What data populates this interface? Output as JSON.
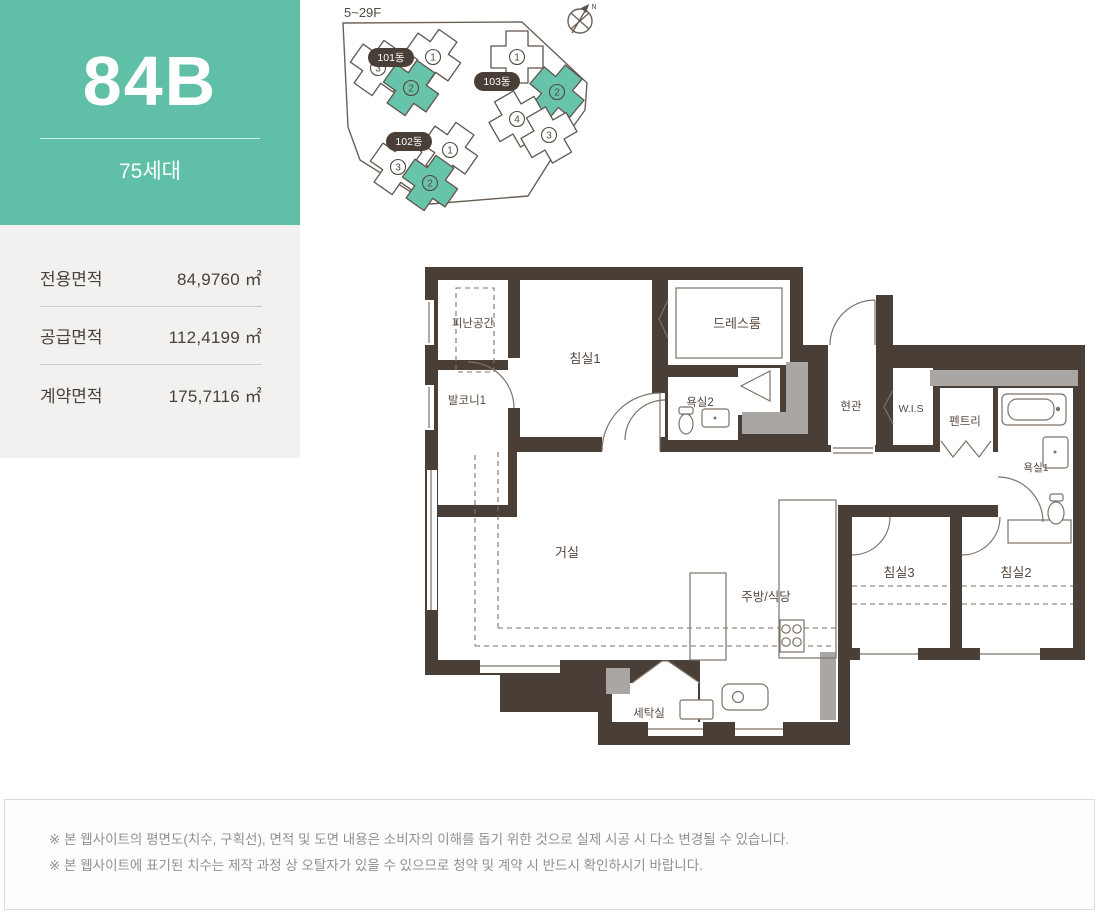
{
  "colors": {
    "accent_teal": "#5fc0a7",
    "building_teal": "#68c3ab",
    "wall": "#493f37",
    "gray_accent": "#a9a6a3",
    "line": "#7d7268",
    "ink": "#57493e",
    "badge": "#4a3f37",
    "panel_bg": "#f2f1ef"
  },
  "unit": {
    "code": "84B",
    "households": "75세대"
  },
  "area_table": {
    "rows": [
      {
        "label": "전용면적",
        "value": "84,9760 ㎡"
      },
      {
        "label": "공급면적",
        "value": "112,4199 ㎡"
      },
      {
        "label": "계약면적",
        "value": "175,7116 ㎡"
      }
    ]
  },
  "site_plan": {
    "floors_label": "5~29F",
    "compass_label": "N",
    "buildings": [
      {
        "name": "101동",
        "units": [
          {
            "no": "3"
          },
          {
            "no": "1"
          },
          {
            "no": "2",
            "highlight": true
          }
        ]
      },
      {
        "name": "102동",
        "units": [
          {
            "no": "3"
          },
          {
            "no": "1"
          },
          {
            "no": "2",
            "highlight": true
          }
        ]
      },
      {
        "name": "103동",
        "units": [
          {
            "no": "1"
          },
          {
            "no": "2",
            "highlight": true
          },
          {
            "no": "4"
          },
          {
            "no": "3"
          }
        ]
      }
    ]
  },
  "floor_plan": {
    "labels": {
      "refuge": "피난공간",
      "balcony1": "발코니1",
      "bedroom1": "침실1",
      "dressroom": "드레스룸",
      "bath2": "욕실2",
      "entry": "현관",
      "wis": "W.I.S",
      "pantry": "펜트리",
      "bath1": "욕실1",
      "living": "거실",
      "kitchen": "주방/식당",
      "bedroom3": "침실3",
      "bedroom2": "침실2",
      "laundry": "세탁실"
    }
  },
  "disclaimer": {
    "lines": [
      "※ 본 웹사이트의 평면도(치수, 구획선), 면적 및 도면 내용은 소비자의 이해를 돕기 위한 것으로 실제 시공 시 다소 변경될 수 있습니다.",
      "※ 본 웹사이트에 표기된 치수는 제작 과정 상 오탈자가 있을 수 있으므로 청약 및 계약 시 반드시 확인하시기 바랍니다."
    ]
  }
}
